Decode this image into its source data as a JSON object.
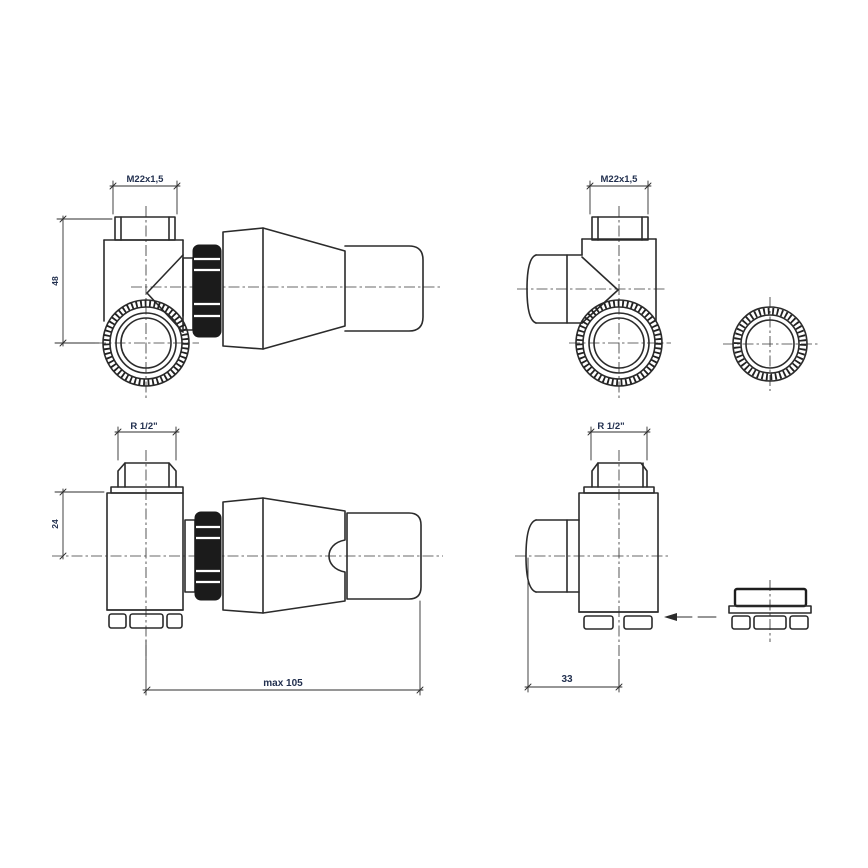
{
  "drawing": {
    "line_color": "#2b2b2b",
    "dim_text_color": "#22304f",
    "adapter_fill": "#1b1b1b",
    "views": {
      "top_left": {
        "thread_label": "M22x1,5",
        "height_label": "48"
      },
      "top_right": {
        "thread_label": "M22x1,5"
      },
      "bottom_left": {
        "thread_label": "R 1/2\"",
        "offset_label": "24",
        "length_label": "max 105"
      },
      "bottom_right": {
        "thread_label": "R 1/2\"",
        "depth_label": "33"
      }
    }
  }
}
